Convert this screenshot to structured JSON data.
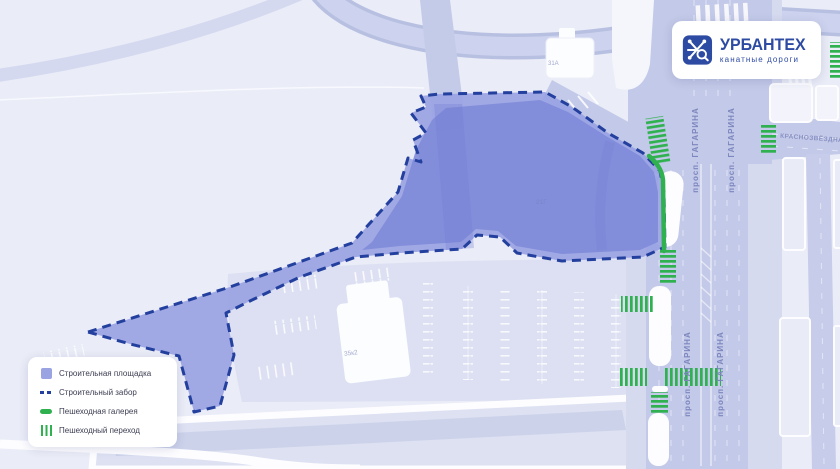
{
  "window": {
    "width": 840,
    "height": 469
  },
  "logo": {
    "title": "УРБАНТЕХ",
    "subtitle": "канатные дороги"
  },
  "legend": {
    "items": [
      {
        "label": "Строительная площадка",
        "swatch": "area"
      },
      {
        "label": "Строительный забор",
        "swatch": "dashed-line"
      },
      {
        "label": "Пешеходная галерея",
        "swatch": "green-solid"
      },
      {
        "label": "Пешеходный переход",
        "swatch": "green-striped"
      }
    ]
  },
  "map": {
    "street_labels": {
      "gagarina": "просп. ГАГАРИНА",
      "krasnozvezdnaya": "КРАСНОЗВЁЗДНАЯ УЛ."
    },
    "building_labels": {
      "b31a": "31А",
      "b21g": "21Г",
      "b35k2": "35к2"
    }
  },
  "colors": {
    "background": "#eaecf7",
    "road": "#c3c9e8",
    "site_fill": "#8f99df",
    "fence": "#24409e",
    "gallery_green": "#2fb14f",
    "logo_blue": "#2e4ba3"
  }
}
